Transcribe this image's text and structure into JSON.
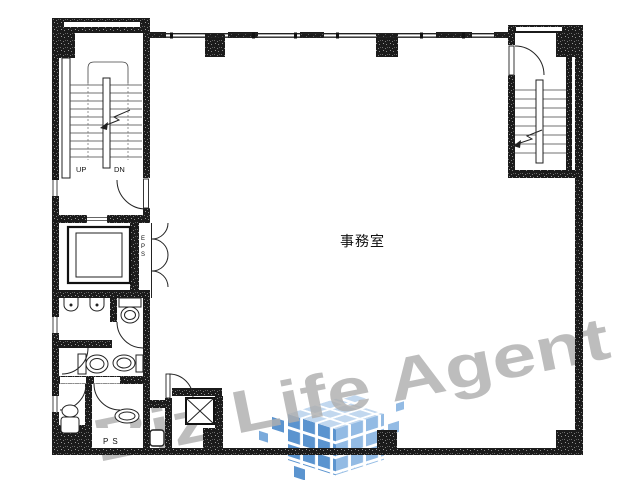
{
  "page": {
    "background": "#ffffff"
  },
  "floor_plan": {
    "room_label": "事務室",
    "stair_up_label": "UP",
    "stair_down_label": "DN",
    "eps_label": "EPS",
    "ps_label": "PS",
    "wall_color": "#1b1b1b"
  },
  "watermark": {
    "text": "Biz Life Agent",
    "text_color": "#a9a9a9",
    "logo_tile_colors": {
      "top": "#bdd5ee",
      "left": "#4e8bcb",
      "right": "#8ab6e2"
    }
  }
}
